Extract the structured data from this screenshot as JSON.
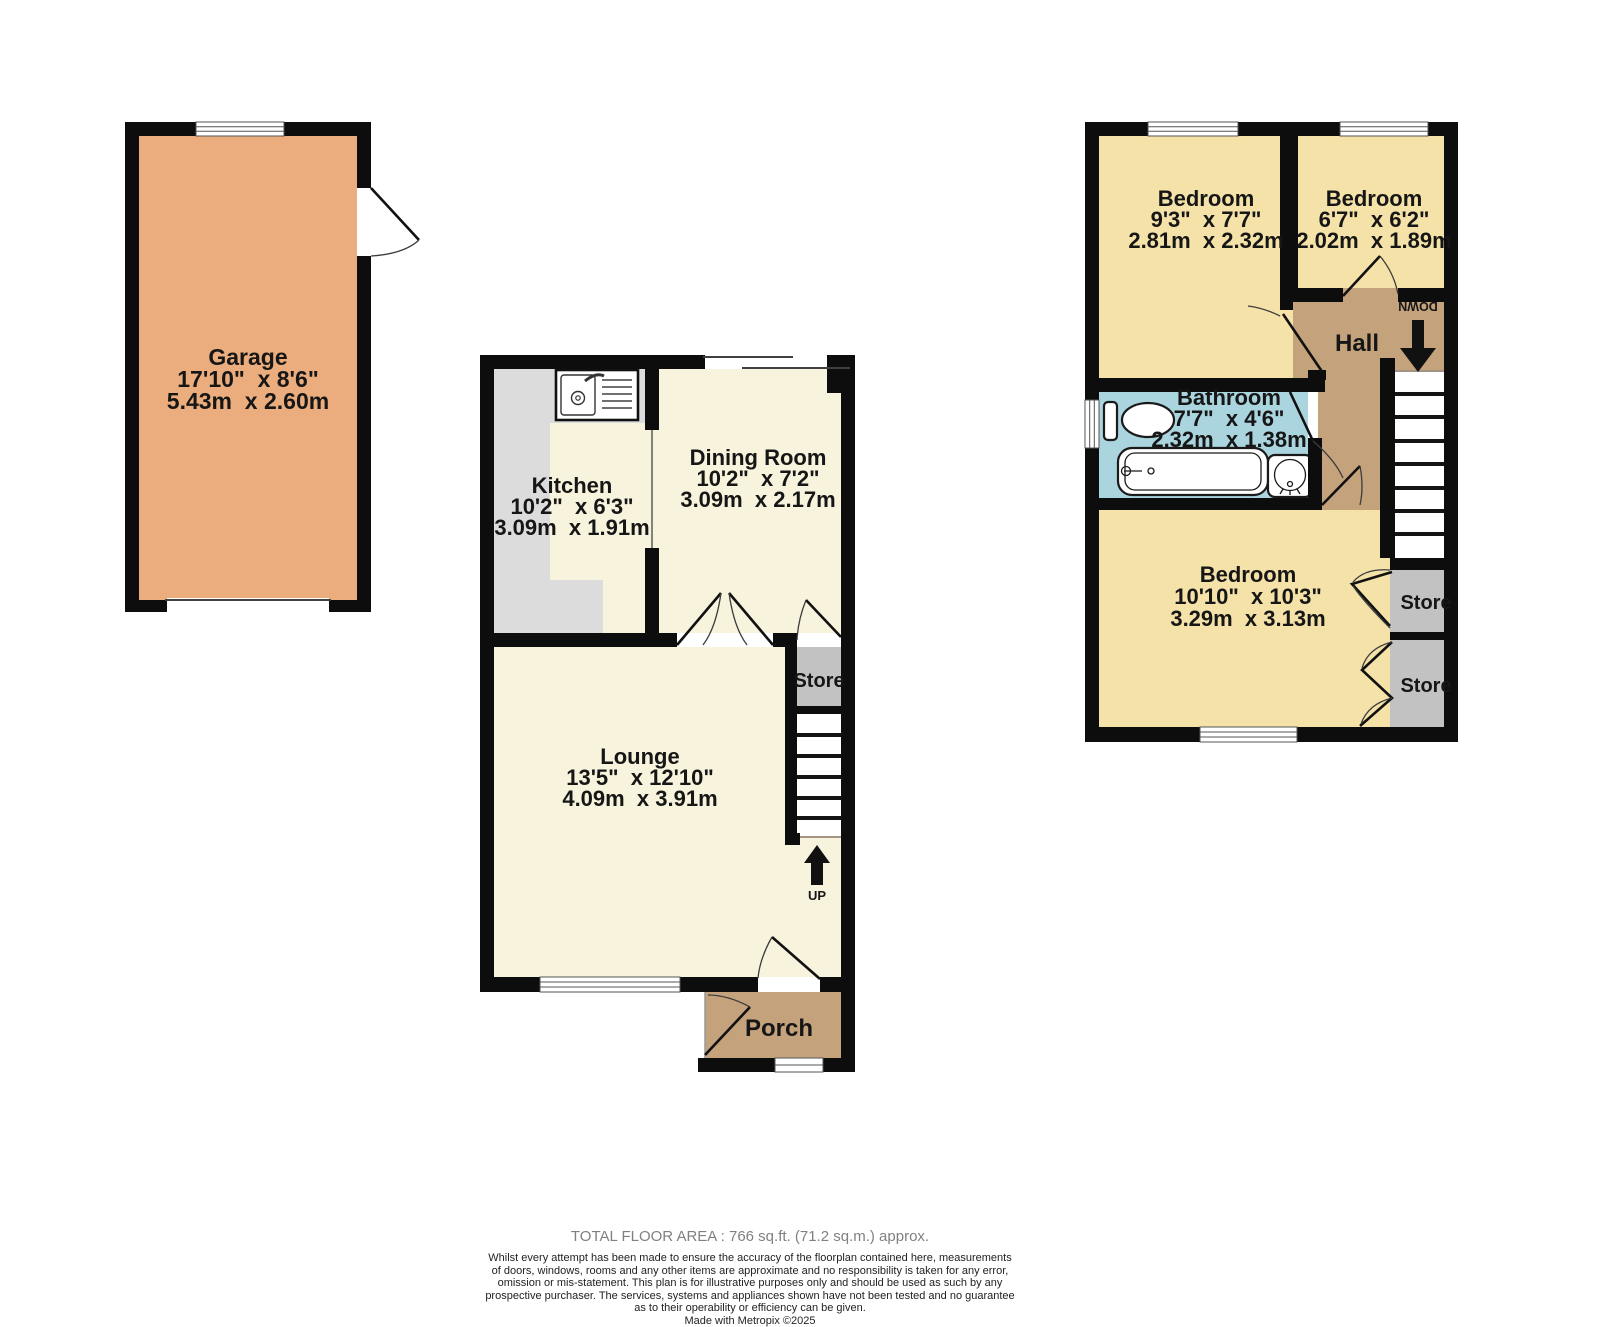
{
  "colors": {
    "wall": "#0d0d0d",
    "floor_cream": "#F8F3DC",
    "floor_gold": "#F5E2A8",
    "garage_fill": "#EBAD7D",
    "hall_tan": "#C3A27C",
    "bathroom_blue": "#AAD4DE",
    "store_gray": "#C2C2C2",
    "counter_gray": "#DCDCDC"
  },
  "garage": {
    "name": "Garage",
    "dims_imperial": "17'10\"  x 8'6\"",
    "dims_metric": "5.43m  x 2.60m"
  },
  "ground_floor": {
    "kitchen": {
      "name": "Kitchen",
      "dims_imperial": "10'2\"  x 6'3\"",
      "dims_metric": "3.09m  x 1.91m"
    },
    "dining_room": {
      "name": "Dining Room",
      "dims_imperial": "10'2\"  x 7'2\"",
      "dims_metric": "3.09m  x 2.17m"
    },
    "lounge": {
      "name": "Lounge",
      "dims_imperial": "13'5\"  x 12'10\"",
      "dims_metric": "4.09m  x 3.91m"
    },
    "store_label": "Store",
    "porch_label": "Porch",
    "up_label": "UP"
  },
  "first_floor": {
    "bedroom_front": {
      "name": "Bedroom",
      "dims_imperial": "9'3\"  x 7'7\"",
      "dims_metric": "2.81m  x 2.32m"
    },
    "bedroom_small": {
      "name": "Bedroom",
      "dims_imperial": "6'7\"  x 6'2\"",
      "dims_metric": "2.02m  x 1.89m"
    },
    "bedroom_back": {
      "name": "Bedroom",
      "dims_imperial": "10'10\"  x 10'3\"",
      "dims_metric": "3.29m  x 3.13m"
    },
    "bathroom": {
      "name": "Bathroom",
      "dims_imperial": "7'7\"  x 4'6\"",
      "dims_metric": "2.32m  x 1.38m"
    },
    "hall_label": "Hall",
    "down_label": "DOWN",
    "store1_label": "Store",
    "store2_label": "Store"
  },
  "footer": {
    "total_area": "TOTAL FLOOR AREA : 766 sq.ft. (71.2 sq.m.) approx.",
    "disclaimer_lines": [
      "Whilst every attempt has been made to ensure the accuracy of the floorplan contained here, measurements",
      "of doors, windows, rooms and any other items are approximate and no responsibility is taken for any error,",
      "omission or mis-statement. This plan is for illustrative purposes only and should be used as such by any",
      "prospective purchaser. The services, systems and appliances shown have not been tested and no guarantee",
      "as to their operability or efficiency can be given.",
      "Made with Metropix ©2025"
    ]
  }
}
